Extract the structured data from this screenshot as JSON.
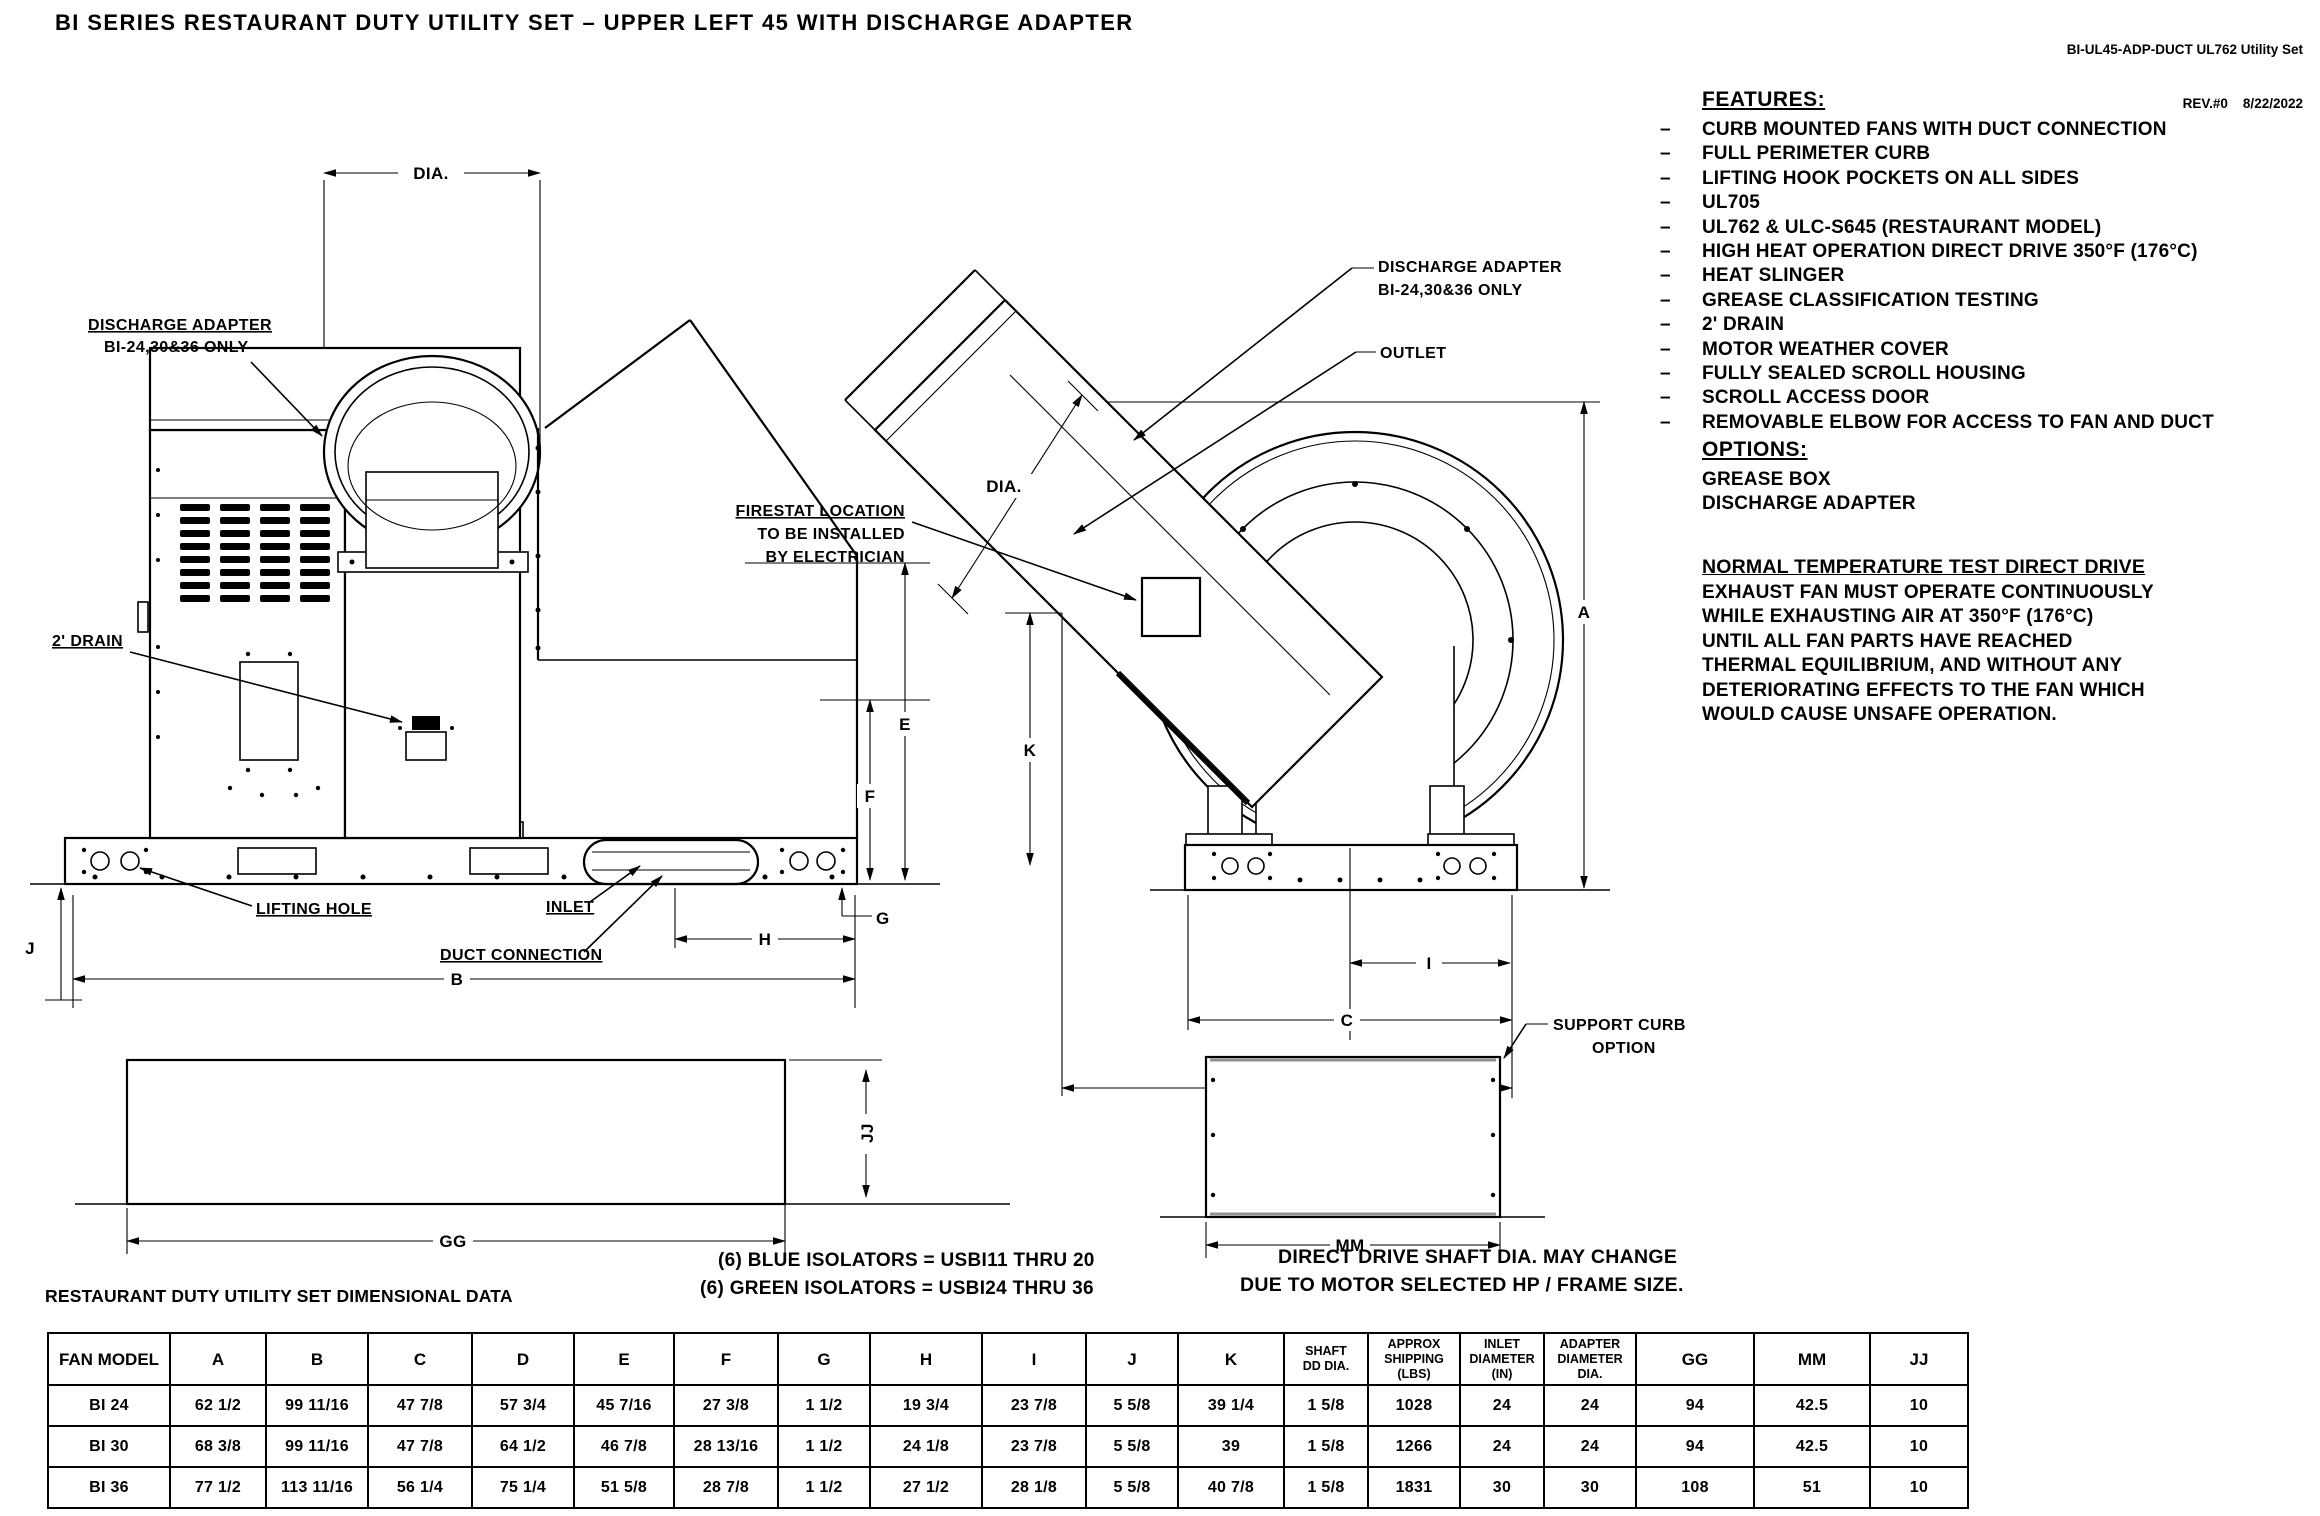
{
  "doc": {
    "title": "BI SERIES RESTAURANT DUTY UTILITY SET – UPPER LEFT 45 WITH DISCHARGE ADAPTER",
    "doc_number": "BI-UL45-ADP-DUCT UL762 Utility Set",
    "revision_line": "REV.#0    8/22/2022"
  },
  "features": {
    "heading": "FEATURES:",
    "bullet": "–",
    "items": [
      "CURB MOUNTED FANS WITH DUCT CONNECTION",
      "FULL PERIMETER CURB",
      "LIFTING HOOK POCKETS ON ALL SIDES",
      "UL705",
      "UL762 & ULC-S645 (RESTAURANT MODEL)",
      "HIGH HEAT OPERATION DIRECT DRIVE 350°F (176°C)",
      "HEAT SLINGER",
      "GREASE CLASSIFICATION TESTING",
      "2' DRAIN",
      "MOTOR WEATHER COVER",
      "FULLY SEALED SCROLL HOUSING",
      "SCROLL ACCESS DOOR",
      "REMOVABLE ELBOW FOR ACCESS TO FAN AND DUCT"
    ]
  },
  "options": {
    "heading": "OPTIONS:",
    "items": [
      "GREASE BOX",
      "DISCHARGE ADAPTER"
    ]
  },
  "normal_temp_test": {
    "heading": "NORMAL TEMPERATURE TEST DIRECT DRIVE",
    "lines": [
      "EXHAUST FAN MUST OPERATE CONTINUOUSLY",
      "WHILE EXHAUSTING AIR AT 350°F (176°C)",
      "UNTIL ALL FAN PARTS HAVE REACHED",
      "THERMAL EQUILIBRIUM, AND WITHOUT ANY",
      "DETERIORATING EFFECTS TO THE FAN WHICH",
      "WOULD CAUSE UNSAFE OPERATION."
    ]
  },
  "notes": {
    "dimensional_data": "RESTAURANT DUTY UTILITY SET DIMENSIONAL DATA",
    "isolators_blue": "(6) BLUE ISOLATORS = USBI11 THRU 20",
    "isolators_green": "(6) GREEN ISOLATORS = USBI24 THRU 36",
    "shaft_note_line1": "DIRECT DRIVE SHAFT DIA. MAY CHANGE",
    "shaft_note_line2": "DUE TO MOTOR SELECTED HP / FRAME SIZE."
  },
  "left_view": {
    "labels": {
      "dia": "DIA.",
      "discharge_adapter_line1": "DISCHARGE ADAPTER",
      "discharge_adapter_line2": "BI-24,30&36 ONLY",
      "drain": "2' DRAIN",
      "lifting_hole": "LIFTING HOLE",
      "inlet": "INLET",
      "duct_connection": "DUCT CONNECTION"
    },
    "dims": {
      "b": "B",
      "e": "E",
      "f": "F",
      "g": "G",
      "h": "H",
      "j": "J"
    }
  },
  "right_view": {
    "labels": {
      "discharge_adapter_line1": "DISCHARGE ADAPTER",
      "discharge_adapter_line2": "BI-24,30&36 ONLY",
      "outlet": "OUTLET",
      "dia": "DIA.",
      "firestat_line1": "FIRESTAT LOCATION",
      "firestat_line2": "TO BE INSTALLED",
      "firestat_line3": "BY ELECTRICIAN",
      "support_curb_line1": "SUPPORT CURB",
      "support_curb_line2": "OPTION"
    },
    "dims": {
      "a": "A",
      "c": "C",
      "d": "D",
      "i": "I",
      "k": "K",
      "mm": "MM"
    }
  },
  "curb_view": {
    "dims": {
      "gg": "GG",
      "jj": "JJ"
    }
  },
  "table": {
    "headers": [
      "FAN MODEL",
      "A",
      "B",
      "C",
      "D",
      "E",
      "F",
      "G",
      "H",
      "I",
      "J",
      "K",
      "SHAFT\nDD DIA.",
      "APPROX\nSHIPPING\n(LBS)",
      "INLET\nDIAMETER\n(IN)",
      "ADAPTER\nDIAMETER\nDIA.",
      "GG",
      "MM",
      "JJ"
    ],
    "rows": [
      [
        "BI 24",
        "62 1/2",
        "99 11/16",
        "47 7/8",
        "57 3/4",
        "45 7/16",
        "27 3/8",
        "1 1/2",
        "19 3/4",
        "23 7/8",
        "5 5/8",
        "39 1/4",
        "1 5/8",
        "1028",
        "24",
        "24",
        "94",
        "42.5",
        "10"
      ],
      [
        "BI 30",
        "68 3/8",
        "99 11/16",
        "47 7/8",
        "64 1/2",
        "46 7/8",
        "28 13/16",
        "1 1/2",
        "24 1/8",
        "23 7/8",
        "5 5/8",
        "39",
        "1 5/8",
        "1266",
        "24",
        "24",
        "94",
        "42.5",
        "10"
      ],
      [
        "BI 36",
        "77 1/2",
        "113 11/16",
        "56 1/4",
        "75 1/4",
        "51 5/8",
        "28 7/8",
        "1 1/2",
        "27 1/2",
        "28 1/8",
        "5 5/8",
        "40 7/8",
        "1 5/8",
        "1831",
        "30",
        "30",
        "108",
        "51",
        "10"
      ]
    ]
  }
}
